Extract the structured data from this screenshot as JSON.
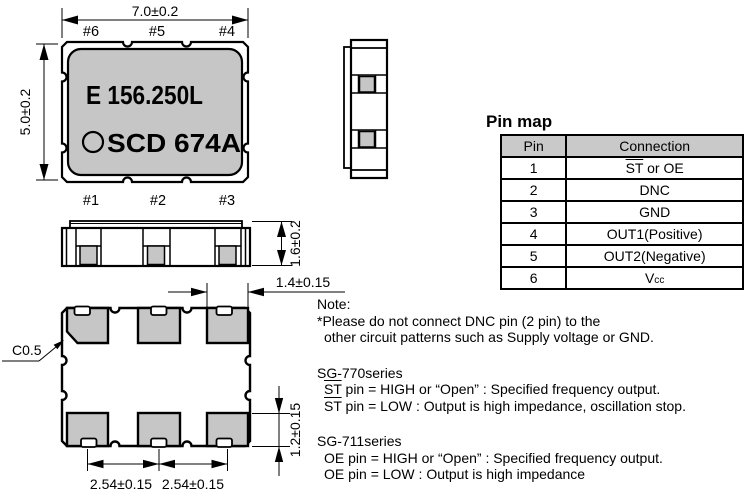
{
  "marking": {
    "line1": "E 156.250L",
    "line2": "SCD 674A"
  },
  "pins": {
    "top": [
      "#6",
      "#5",
      "#4"
    ],
    "bottom": [
      "#1",
      "#2",
      "#3"
    ]
  },
  "dimensions": {
    "body_width": "7.0±0.2",
    "body_height": "5.0±0.2",
    "thickness": "1.6±0.2",
    "pad_width": "1.4±0.15",
    "pad_pitch_left": "2.54±0.15",
    "pad_pitch_right": "2.54±0.15",
    "pad_height": "1.2±0.15",
    "corner_chamfer": "C0.5"
  },
  "pin_map": {
    "title": "Pin map",
    "columns": [
      "Pin",
      "Connection"
    ],
    "rows": [
      {
        "pin": "1",
        "connection": [
          {
            "t": "ST",
            "overline": true
          },
          " or OE"
        ]
      },
      {
        "pin": "2",
        "connection": [
          "DNC"
        ]
      },
      {
        "pin": "3",
        "connection": [
          "GND"
        ]
      },
      {
        "pin": "4",
        "connection": [
          "OUT1(Positive)"
        ]
      },
      {
        "pin": "5",
        "connection": [
          "OUT2(Negative)"
        ]
      },
      {
        "pin": "6",
        "connection": [
          "V",
          {
            "t": "cc",
            "sub": true
          }
        ]
      }
    ]
  },
  "notes": {
    "heading": "Note:",
    "lines": [
      {
        "parts": [
          "*Please do not connect DNC pin (2 pin) to the"
        ]
      },
      {
        "parts": [
          "other circuit patterns such as Supply voltage or GND."
        ],
        "indent": 1
      },
      {
        "parts": [
          "SG-770series"
        ],
        "gap": 1
      },
      {
        "parts": [
          {
            "t": "ST",
            "overline": true
          },
          " pin = HIGH or “Open” : Specified frequency output."
        ],
        "indent": 1
      },
      {
        "parts": [
          {
            "t": "ST",
            "overline": true
          },
          " pin = LOW : Output is high impedance, oscillation stop."
        ],
        "indent": 1
      },
      {
        "parts": [
          "SG-711series"
        ],
        "gap": 1
      },
      {
        "parts": [
          "OE pin = HIGH or “Open” : Specified frequency output."
        ],
        "indent": 1
      },
      {
        "parts": [
          "OE pin = LOW : Output is high impedance"
        ],
        "indent": 1
      }
    ]
  },
  "colors": {
    "body_gray": "#c6c6c6",
    "header_gray": "#c9c9c9",
    "line": "#000000"
  }
}
